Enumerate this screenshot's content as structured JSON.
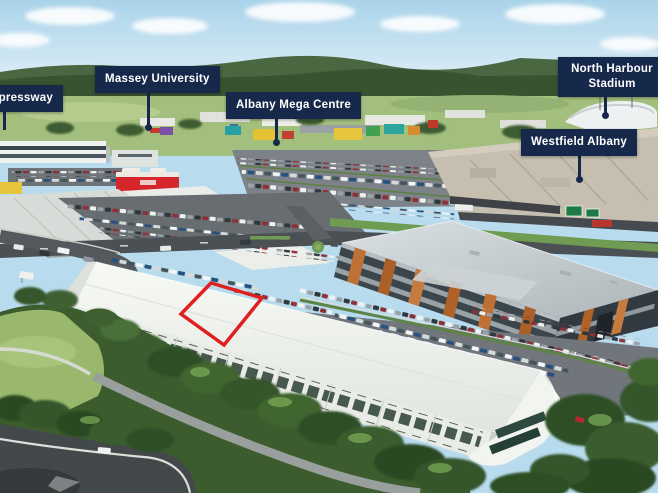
{
  "scene": {
    "type": "aerial-photograph",
    "description": "Aerial view of the Albany commercial precinct with landmark callouts and the subject unit outlined in red"
  },
  "callouts": [
    {
      "id": "expressway",
      "text": "Expressway"
    },
    {
      "id": "massey-university",
      "text": "Massey University"
    },
    {
      "id": "albany-mega-centre",
      "text": "Albany Mega Centre"
    },
    {
      "id": "north-harbour-stadium",
      "text": "North Harbour Stadium"
    },
    {
      "id": "westfield-albany",
      "text": "Westfield Albany"
    }
  ],
  "highlight": {
    "id": "subject-unit",
    "shape": "red-outline"
  },
  "colors": {
    "callout_background": "#16294b",
    "callout_text": "#ffffff",
    "highlight_outline": "#e01f1f",
    "sky": "#b8dcee",
    "vegetation": "#3a5c2e",
    "roof_white": "#f2f4f0"
  }
}
